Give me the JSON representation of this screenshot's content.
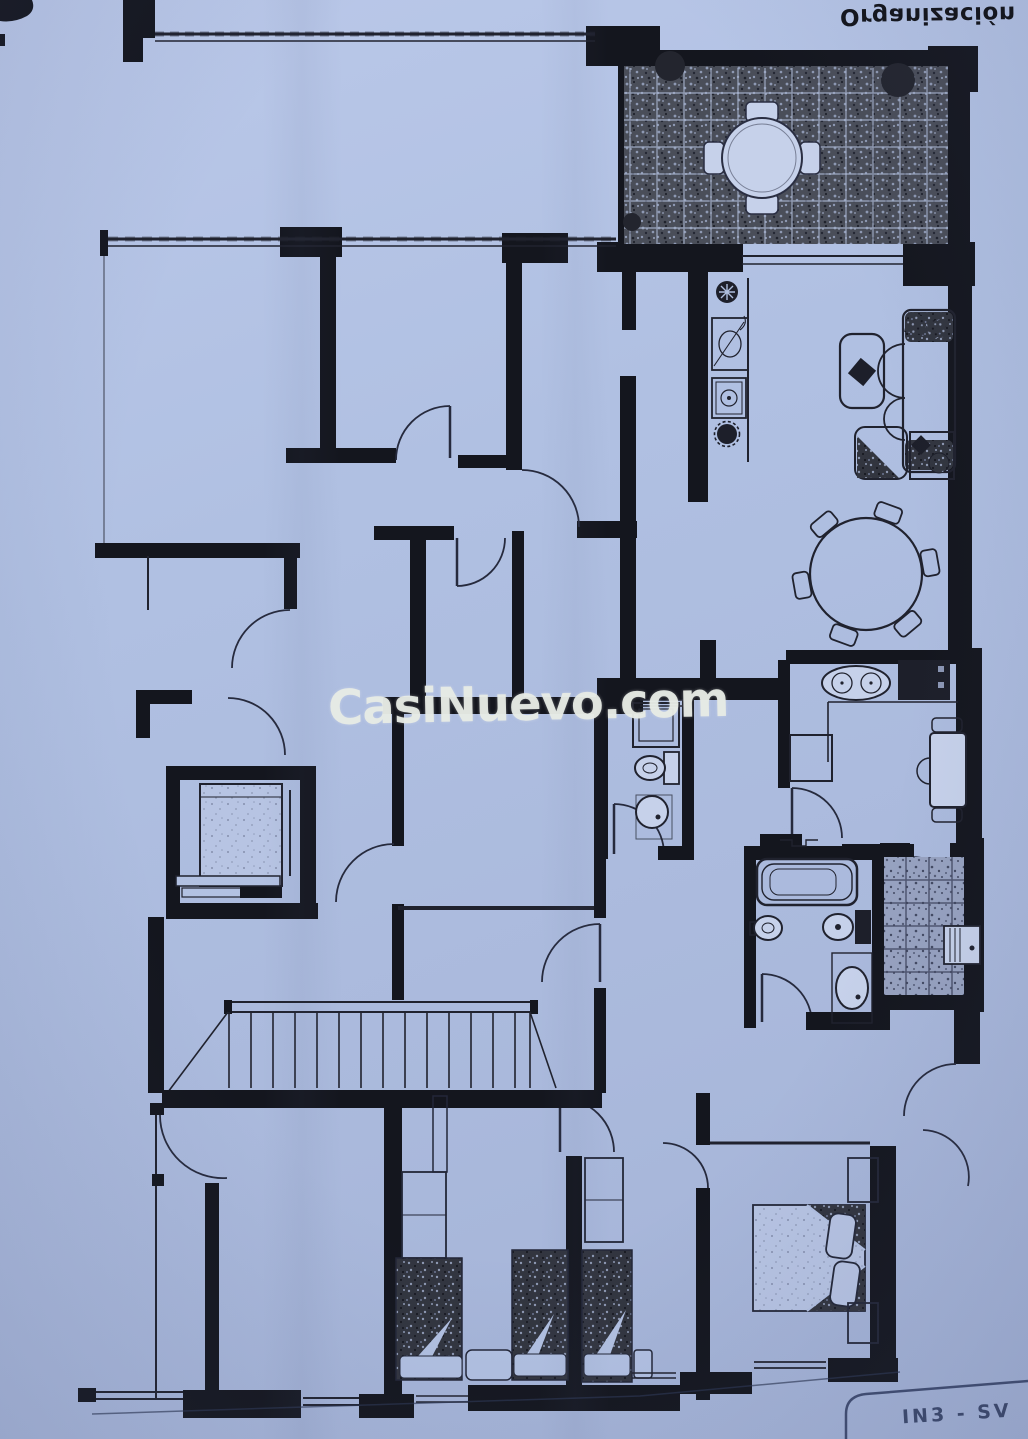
{
  "photo": {
    "paper_color": "#aebede",
    "ink_color": "#14161e",
    "watermark": {
      "text": "CasiNuevo.com",
      "color": "#e6eae4"
    },
    "header_label": {
      "text": "Organización",
      "orientation": "upside-down"
    },
    "footer_label": {
      "text": "IN3 - SV",
      "orientation": "upside-down-fragment"
    }
  },
  "floorplan": {
    "kind": "scanned apartment floor plan photo",
    "areas": [
      "terrace",
      "living-room",
      "dining-area",
      "kitchen",
      "hall",
      "corridor",
      "wc",
      "bathroom",
      "laundry-patio",
      "elevator-core",
      "staircase",
      "bedroom-1",
      "bedroom-2",
      "master-bedroom",
      "empty-rooms"
    ],
    "furniture_icons": [
      "terrace-table-icon",
      "bush-icon",
      "sofa-icon",
      "armchair-icon",
      "coffee-table-icon",
      "side-table-icon",
      "plant-icon",
      "dining-table-icon",
      "double-sink-icon",
      "stove-icon",
      "fridge-icon",
      "breakfast-table-icon",
      "shower-icon",
      "toilet-icon",
      "bidet-icon",
      "washbasin-icon",
      "bathtub-icon",
      "washing-machine-icon",
      "elevator-car-icon",
      "stairs-icon",
      "single-bed-icon",
      "double-bed-icon",
      "wardrobe-icon",
      "nightstand-icon",
      "fan-icon",
      "gear-icon"
    ]
  }
}
